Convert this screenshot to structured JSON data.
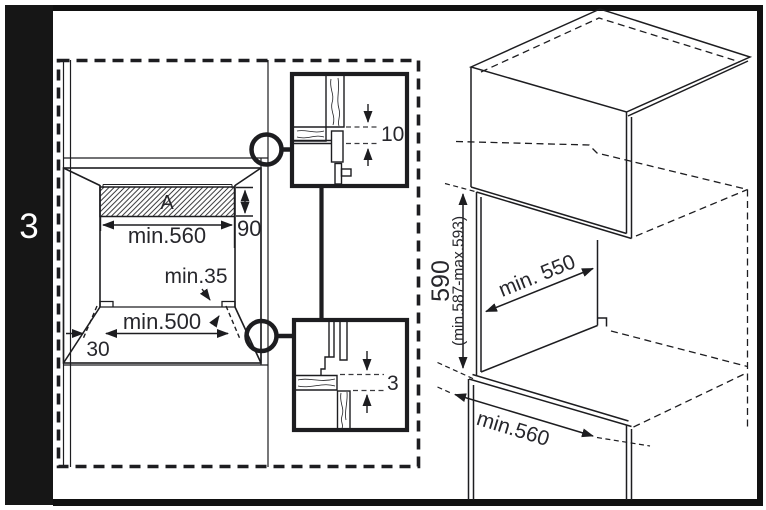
{
  "page": {
    "background": "#ffffff",
    "line_color": "#1d1d20",
    "text_color": "#27272c",
    "frame_color": "#111111"
  },
  "sidebar": {
    "step_number": "3"
  },
  "front_view": {
    "panel_label": "A",
    "width_dim": "min.560",
    "panel_height_dim": "90",
    "corner_gap_dim": "min.35",
    "bottom_width_dim": "min.500",
    "plinth_dim": "30"
  },
  "details": {
    "top_gap_dim": "10",
    "bottom_gap_dim": "3"
  },
  "iso_view": {
    "height_dim": "590",
    "height_range_dim": "(min.587-max.593)",
    "depth_dim": "min. 550",
    "width_dim": "min.560"
  }
}
